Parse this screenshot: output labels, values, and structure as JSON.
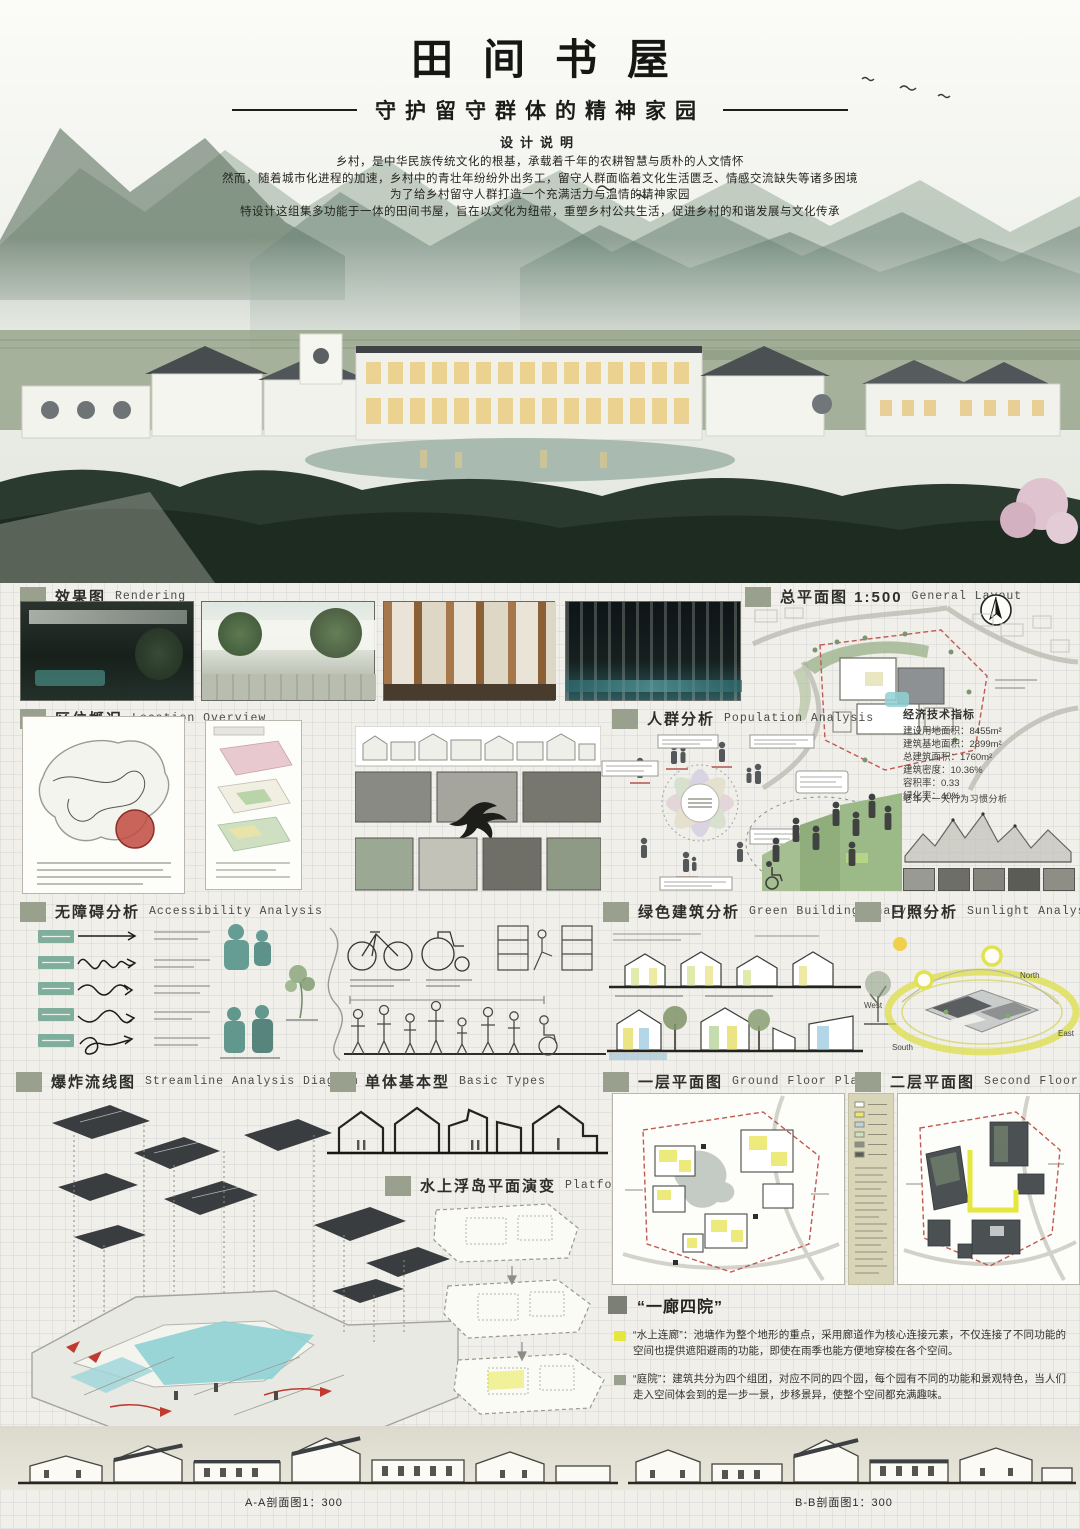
{
  "poster": {
    "title": "田间书屋",
    "subtitle": "守护留守群体的精神家园",
    "intro_heading": "设计说明",
    "intro_lines": [
      "乡村，是中华民族传统文化的根基，承载着千年的农耕智慧与质朴的人文情怀",
      "然而，随着城市化进程的加速，乡村中的青壮年纷纷外出务工，留守人群面临着文化生活匮乏、情感交流缺失等诸多困境",
      "为了给乡村留守人群打造一个充满活力与温情的精神家园",
      "特设计这组集多功能于一体的田间书屋，旨在以文化为纽带，重塑乡村公共生活，促进乡村的和谐发展与文化传承"
    ]
  },
  "sections": {
    "rendering": {
      "zh": "效果图",
      "en": "Rendering"
    },
    "layout": {
      "zh": "总平面图 1:500",
      "en": "General Layout"
    },
    "location": {
      "zh": "区位概况",
      "en": "Location Overview"
    },
    "population": {
      "zh": "人群分析",
      "en": "Population Analysis"
    },
    "accessibility": {
      "zh": "无障碍分析",
      "en": "Accessibility Analysis"
    },
    "green": {
      "zh": "绿色建筑分析",
      "en": "Green Building Analysis"
    },
    "sunlight": {
      "zh": "日照分析",
      "en": "Sunlight Analysis"
    },
    "streamline": {
      "zh": "爆炸流线图",
      "en": "Streamline Analysis Diagram"
    },
    "basic": {
      "zh": "单体基本型",
      "en": "Basic Types"
    },
    "platform": {
      "zh": "水上浮岛平面演变",
      "en": "Platform Planes"
    },
    "floor1": {
      "zh": "一层平面图",
      "en": "Ground Floor Plan"
    },
    "floor2": {
      "zh": "二层平面图",
      "en": "Second Floor Plan"
    }
  },
  "indicators": {
    "title": "经济技术指标",
    "lines": [
      "建设用地面积：8455m²",
      "建筑基地面积：2899m²",
      "总建筑面积：1760m²",
      "建筑密度：10.36%",
      "容积率：0.33",
      "绿化率：40%"
    ]
  },
  "population_notes": {
    "elderly_note": "老年人一天行为习惯分析"
  },
  "sunlight_labels": {
    "north": "North",
    "east": "East",
    "south": "South",
    "west": "West"
  },
  "concept": {
    "heading": "“一廊四院”",
    "items": [
      {
        "text": "“水上连廊”：池塘作为整个地形的重点，采用廊道作为核心连接元素，不仅连接了不同功能的空间也提供遮阳避雨的功能，即使在雨季也能方便地穿梭在各个空间。"
      },
      {
        "text": "“庭院”：建筑共分为四个组团，对应不同的四个园，每个园有不同的功能和景观特色，当人们走入空间体会到的是一步一景，步移景异，使整个空间都充满趣味。"
      }
    ]
  },
  "footer": {
    "section_a": "A-A剖面图1：300",
    "section_b": "B-B剖面图1：300"
  },
  "colors": {
    "header_square": "#9aa08e",
    "highlight_yellow": "#e6e73c",
    "water_teal": "#8fd0d4",
    "roof_dark": "#3a3d3f"
  }
}
